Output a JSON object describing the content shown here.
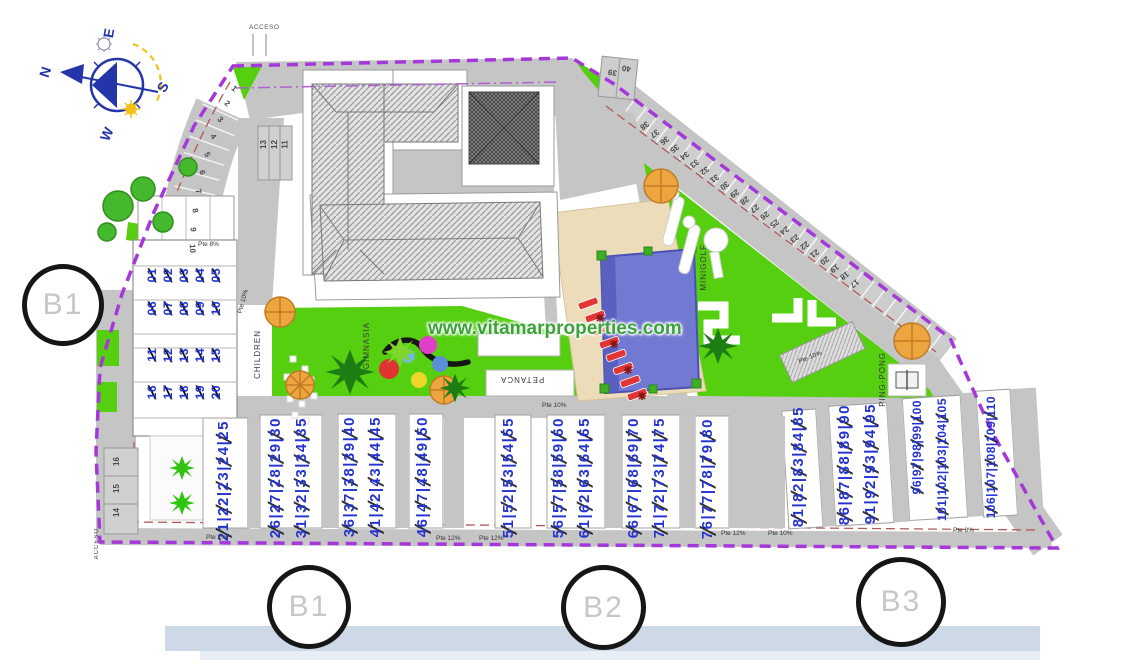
{
  "watermark": "www.vitamarproperties.com",
  "compass": {
    "north": "N",
    "east": "E",
    "south": "S",
    "west": "W"
  },
  "labels": {
    "acceso_top": "ACCESO",
    "acceso_side": "ACCESO",
    "children": "CHILDREN",
    "gimnasia": "GIMNASIA",
    "petanca": "PETANCA",
    "minigolf": "MINIGOLF",
    "ping_pong": "PING-PONG"
  },
  "markers": [
    {
      "label": "B1"
    },
    {
      "label": "B1"
    },
    {
      "label": "B2"
    },
    {
      "label": "B3"
    }
  ],
  "colors": {
    "boundary": "#a438d8",
    "green": "#55cf10",
    "road": "#c5c5c5",
    "pool": "#7279d2",
    "deck": "#ecdcba",
    "unit_number": "#2433cf",
    "water_band": "#cdd9e6",
    "lounger": "#e03636",
    "tree_orange": "#eda63f"
  },
  "unit_groups": [
    {
      "label": "21|22|23|24|25",
      "x": 216,
      "y": 420
    },
    {
      "label": "26|27|28|29|30",
      "x": 268,
      "y": 417
    },
    {
      "label": "31|32|33|34|35",
      "x": 294,
      "y": 417
    },
    {
      "label": "36|37|38|39|40",
      "x": 342,
      "y": 416
    },
    {
      "label": "41|42|43|44|45",
      "x": 368,
      "y": 416
    },
    {
      "label": "46|47|48|49|50",
      "x": 415,
      "y": 416
    },
    {
      "label": "51|52|53|54|55",
      "x": 501,
      "y": 417
    },
    {
      "label": "56|57|58|59|60",
      "x": 551,
      "y": 417
    },
    {
      "label": "61|62|63|64|65",
      "x": 577,
      "y": 417
    },
    {
      "label": "66|67|68|69|70",
      "x": 626,
      "y": 417
    },
    {
      "label": "71|72|73|74|75",
      "x": 652,
      "y": 417
    },
    {
      "label": "76|77|78|79|80",
      "x": 700,
      "y": 418
    },
    {
      "label": "81|82|83|84|85",
      "x": 791,
      "y": 406
    },
    {
      "label": "86|87|88|89|90",
      "x": 837,
      "y": 404
    },
    {
      "label": "91|92|93|94|95",
      "x": 863,
      "y": 403
    },
    {
      "label": "96|97|98|99|100",
      "x": 911,
      "y": 400,
      "cls": "long"
    },
    {
      "label": "101|102|103|104|105",
      "x": 936,
      "y": 398,
      "cls": "long"
    },
    {
      "label": "106|107|108|109|110",
      "x": 985,
      "y": 396,
      "cls": "long"
    }
  ],
  "garage_units": [
    {
      "label": "01",
      "x": 146,
      "y": 268
    },
    {
      "label": "02",
      "x": 162,
      "y": 268
    },
    {
      "label": "03",
      "x": 178,
      "y": 268
    },
    {
      "label": "04",
      "x": 194,
      "y": 268
    },
    {
      "label": "05",
      "x": 210,
      "y": 268
    },
    {
      "label": "06",
      "x": 146,
      "y": 301
    },
    {
      "label": "07",
      "x": 162,
      "y": 301
    },
    {
      "label": "08",
      "x": 178,
      "y": 301
    },
    {
      "label": "09",
      "x": 194,
      "y": 301
    },
    {
      "label": "10",
      "x": 210,
      "y": 301
    },
    {
      "label": "11",
      "x": 146,
      "y": 348
    },
    {
      "label": "12",
      "x": 162,
      "y": 348
    },
    {
      "label": "13",
      "x": 178,
      "y": 348
    },
    {
      "label": "14",
      "x": 194,
      "y": 348
    },
    {
      "label": "15",
      "x": 210,
      "y": 348
    },
    {
      "label": "16",
      "x": 146,
      "y": 385
    },
    {
      "label": "17",
      "x": 162,
      "y": 385
    },
    {
      "label": "18",
      "x": 178,
      "y": 385
    },
    {
      "label": "19",
      "x": 194,
      "y": 385
    },
    {
      "label": "20",
      "x": 210,
      "y": 385
    }
  ],
  "parking": [
    {
      "label": "1",
      "x": 232,
      "y": 84,
      "rot": 38
    },
    {
      "label": "2",
      "x": 225,
      "y": 99,
      "rot": 42
    },
    {
      "label": "3",
      "x": 218,
      "y": 115,
      "rot": 48
    },
    {
      "label": "4",
      "x": 211,
      "y": 132,
      "rot": 55
    },
    {
      "label": "5",
      "x": 205,
      "y": 150,
      "rot": 62
    },
    {
      "label": "6",
      "x": 200,
      "y": 168,
      "rot": 68
    },
    {
      "label": "7",
      "x": 196,
      "y": 187,
      "rot": 74
    },
    {
      "label": "8",
      "x": 193,
      "y": 206,
      "rot": 80
    },
    {
      "label": "9",
      "x": 191,
      "y": 225,
      "rot": 85
    },
    {
      "label": "10",
      "x": 188,
      "y": 244,
      "rot": 88
    },
    {
      "label": "13",
      "x": 259,
      "y": 140,
      "rot": -90
    },
    {
      "label": "12",
      "x": 270,
      "y": 140,
      "rot": -90
    },
    {
      "label": "11",
      "x": 281,
      "y": 140,
      "rot": -90
    },
    {
      "label": "14",
      "x": 112,
      "y": 508,
      "rot": -90
    },
    {
      "label": "15",
      "x": 112,
      "y": 484,
      "rot": -90
    },
    {
      "label": "16",
      "x": 112,
      "y": 457,
      "rot": -90
    },
    {
      "label": "17",
      "x": 850,
      "y": 279,
      "rot": 143
    },
    {
      "label": "18",
      "x": 840,
      "y": 271,
      "rot": 143
    },
    {
      "label": "19",
      "x": 830,
      "y": 264,
      "rot": 143
    },
    {
      "label": "20",
      "x": 820,
      "y": 256,
      "rot": 143
    },
    {
      "label": "21",
      "x": 810,
      "y": 249,
      "rot": 143
    },
    {
      "label": "22",
      "x": 800,
      "y": 241,
      "rot": 143
    },
    {
      "label": "23",
      "x": 790,
      "y": 234,
      "rot": 143
    },
    {
      "label": "24",
      "x": 780,
      "y": 226,
      "rot": 143
    },
    {
      "label": "25",
      "x": 770,
      "y": 219,
      "rot": 143
    },
    {
      "label": "26",
      "x": 760,
      "y": 211,
      "rot": 143
    },
    {
      "label": "27",
      "x": 750,
      "y": 204,
      "rot": 143
    },
    {
      "label": "28",
      "x": 740,
      "y": 196,
      "rot": 143
    },
    {
      "label": "29",
      "x": 730,
      "y": 189,
      "rot": 143
    },
    {
      "label": "30",
      "x": 720,
      "y": 181,
      "rot": 143
    },
    {
      "label": "31",
      "x": 710,
      "y": 174,
      "rot": 143
    },
    {
      "label": "32",
      "x": 700,
      "y": 166,
      "rot": 143
    },
    {
      "label": "33",
      "x": 690,
      "y": 159,
      "rot": 143
    },
    {
      "label": "34",
      "x": 680,
      "y": 151,
      "rot": 143
    },
    {
      "label": "35",
      "x": 670,
      "y": 144,
      "rot": 143
    },
    {
      "label": "36",
      "x": 660,
      "y": 136,
      "rot": 143
    },
    {
      "label": "37",
      "x": 650,
      "y": 129,
      "rot": 143
    },
    {
      "label": "38",
      "x": 640,
      "y": 121,
      "rot": 143
    },
    {
      "label": "39",
      "x": 608,
      "y": 68,
      "rot": 188
    },
    {
      "label": "40",
      "x": 622,
      "y": 64,
      "rot": 188
    }
  ],
  "slopes": [
    {
      "label": "Pte 8%",
      "x": 198,
      "y": 241
    },
    {
      "label": "Pte 10%",
      "x": 231,
      "y": 298,
      "rot": -75
    },
    {
      "label": "Pte 2%",
      "x": 206,
      "y": 534
    },
    {
      "label": "Pte 12%",
      "x": 436,
      "y": 535
    },
    {
      "label": "Pte 12%",
      "x": 479,
      "y": 535
    },
    {
      "label": "Pte 10%",
      "x": 542,
      "y": 402
    },
    {
      "label": "Pte 12%",
      "x": 721,
      "y": 530
    },
    {
      "label": "Pte 10%",
      "x": 768,
      "y": 530
    },
    {
      "label": "Pte 10%",
      "x": 798,
      "y": 354,
      "rot": -22
    },
    {
      "label": "Pte 8%",
      "x": 953,
      "y": 527
    }
  ]
}
